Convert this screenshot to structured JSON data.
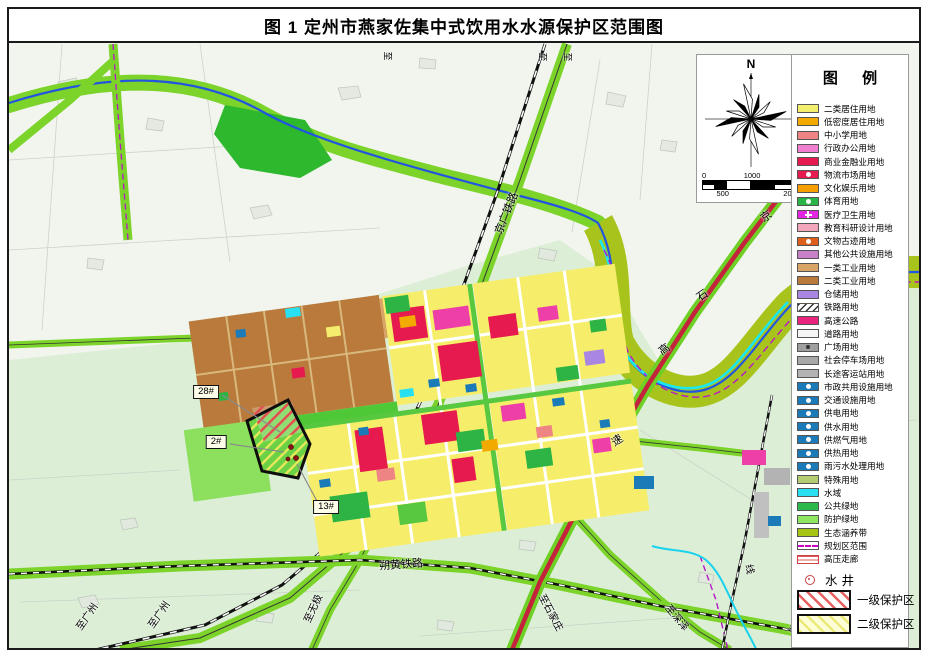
{
  "title": "图 1  定州市燕家佐集中式饮用水水源保护区范围图",
  "compass": {
    "north_label": "N"
  },
  "scale_bar": {
    "labels": [
      "0",
      "500",
      "1000",
      "2000"
    ]
  },
  "legend": {
    "title": "图 例",
    "items": [
      {
        "label": "二类居住用地",
        "color": "#f4ee6e",
        "style": "solid"
      },
      {
        "label": "低密度居住用地",
        "color": "#f2a900",
        "style": "solid"
      },
      {
        "label": "中小学用地",
        "color": "#ee8484",
        "style": "solid"
      },
      {
        "label": "行政办公用地",
        "color": "#f07fd2",
        "style": "solid"
      },
      {
        "label": "商业金融业用地",
        "color": "#e61a4e",
        "style": "solid"
      },
      {
        "label": "物流市场用地",
        "color": "#e61a4e",
        "style": "icon-disc"
      },
      {
        "label": "文化娱乐用地",
        "color": "#f59e00",
        "style": "solid"
      },
      {
        "label": "体育用地",
        "color": "#28b446",
        "style": "icon-disc"
      },
      {
        "label": "医疗卫生用地",
        "color": "#e226e2",
        "style": "icon-cross"
      },
      {
        "label": "教育科研设计用地",
        "color": "#f2a6bc",
        "style": "solid"
      },
      {
        "label": "文物古迹用地",
        "color": "#dd5f1a",
        "style": "icon-disc"
      },
      {
        "label": "其他公共设施用地",
        "color": "#c77fc7",
        "style": "solid"
      },
      {
        "label": "一类工业用地",
        "color": "#d9a567",
        "style": "solid"
      },
      {
        "label": "二类工业用地",
        "color": "#b97a3b",
        "style": "solid"
      },
      {
        "label": "仓储用地",
        "color": "#a886e2",
        "style": "solid"
      },
      {
        "label": "铁路用地",
        "color": "#ffffff",
        "style": "hatch-black"
      },
      {
        "label": "高速公路",
        "color": "#e8247e",
        "style": "solid"
      },
      {
        "label": "道路用地",
        "color": "#f5f5f5",
        "style": "solid"
      },
      {
        "label": "广场用地",
        "color": "#9f9f9f",
        "style": "icon-dot"
      },
      {
        "label": "社会停车场用地",
        "color": "#a8a8a8",
        "style": "solid"
      },
      {
        "label": "长途客运站用地",
        "color": "#b3b3b3",
        "style": "solid"
      },
      {
        "label": "市政共用设施用地",
        "color": "#1b7ab8",
        "style": "icon-disc"
      },
      {
        "label": "交通设施用地",
        "color": "#1b7ab8",
        "style": "icon-disc"
      },
      {
        "label": "供电用地",
        "color": "#1b7ab8",
        "style": "icon-disc"
      },
      {
        "label": "供水用地",
        "color": "#1b7ab8",
        "style": "icon-disc"
      },
      {
        "label": "供燃气用地",
        "color": "#1b7ab8",
        "style": "icon-disc"
      },
      {
        "label": "供热用地",
        "color": "#1b7ab8",
        "style": "icon-disc"
      },
      {
        "label": "雨污水处理用地",
        "color": "#1b7ab8",
        "style": "icon-disc"
      },
      {
        "label": "特殊用地",
        "color": "#b5cd72",
        "style": "solid"
      },
      {
        "label": "水域",
        "color": "#27e0f2",
        "style": "solid"
      },
      {
        "label": "公共绿地",
        "color": "#2db84c",
        "style": "solid"
      },
      {
        "label": "防护绿地",
        "color": "#8fe663",
        "style": "solid"
      },
      {
        "label": "生态涵养带",
        "color": "#a6c416",
        "style": "solid"
      },
      {
        "label": "规划区范围",
        "color": "#cc00cc",
        "style": "dash-line"
      },
      {
        "label": "高压走廊",
        "color": "#dd4444",
        "style": "hlines"
      }
    ],
    "well": {
      "label": "水井"
    },
    "zones": [
      {
        "label": "一级保护区",
        "style": "red-hatch"
      },
      {
        "label": "二级保护区",
        "style": "yellow-hatch"
      }
    ]
  },
  "map": {
    "labels": [
      {
        "text": "京广铁路",
        "x": 506,
        "y": 213,
        "rot": -68,
        "size": 11
      },
      {
        "text": "朔黄铁路",
        "x": 401,
        "y": 564,
        "rot": -4,
        "size": 11
      },
      {
        "text": "至广州",
        "x": 86,
        "y": 616,
        "rot": -55,
        "size": 10
      },
      {
        "text": "至广州",
        "x": 158,
        "y": 614,
        "rot": -55,
        "size": 10
      },
      {
        "text": "至无极",
        "x": 312,
        "y": 608,
        "rot": -65,
        "size": 10
      },
      {
        "text": "至石家庄",
        "x": 552,
        "y": 612,
        "rot": 62,
        "size": 10
      },
      {
        "text": "至深泽",
        "x": 678,
        "y": 617,
        "rot": 50,
        "size": 10
      },
      {
        "text": "至黄",
        "x": 798,
        "y": 630,
        "rot": 28,
        "size": 10
      },
      {
        "text": "线",
        "x": 751,
        "y": 569,
        "rot": 78,
        "size": 10
      },
      {
        "text": "京",
        "x": 766,
        "y": 216,
        "rot": -35,
        "size": 11
      },
      {
        "text": "石",
        "x": 702,
        "y": 295,
        "rot": -35,
        "size": 11
      },
      {
        "text": "高",
        "x": 664,
        "y": 349,
        "rot": -35,
        "size": 11
      },
      {
        "text": "速",
        "x": 617,
        "y": 440,
        "rot": -35,
        "size": 11
      },
      {
        "text": "至",
        "x": 388,
        "y": 56,
        "rot": 90,
        "size": 9
      },
      {
        "text": "至",
        "x": 543,
        "y": 57,
        "rot": 90,
        "size": 9
      },
      {
        "text": "至",
        "x": 568,
        "y": 57,
        "rot": 90,
        "size": 9
      }
    ],
    "callouts": [
      {
        "text": "28#",
        "x": 206,
        "y": 392
      },
      {
        "text": "2#",
        "x": 216,
        "y": 442
      },
      {
        "text": "13#",
        "x": 326,
        "y": 507
      }
    ]
  }
}
